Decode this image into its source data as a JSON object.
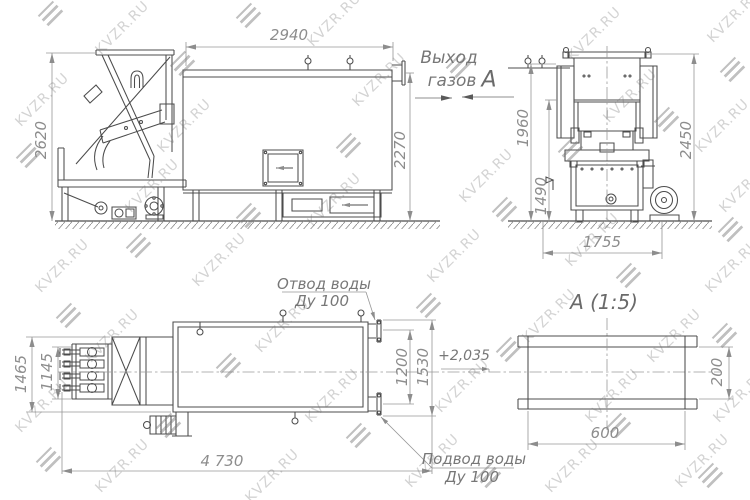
{
  "page": {
    "background": "#ffffff",
    "line_color": "#4c4c4c",
    "dim_color": "#8d8d8d"
  },
  "watermark": {
    "text": "KVZR.RU"
  },
  "drawing": {
    "type": "technical-drawing-boiler",
    "labels": {
      "gas_outlet_line1": "Выход",
      "gas_outlet_line2": "газов",
      "view_arrow_letter": "А",
      "section_title": "А  (1:5)",
      "water_outlet_line1": "Отвод воды",
      "water_outlet_line2": "Ду 100",
      "water_inlet_line1": "Подвод воды",
      "water_inlet_line2": "Ду 100"
    },
    "dimensions": {
      "side_width": "2940",
      "side_height": "2620",
      "side_outlet_height": "2270",
      "front_height_inner": "1960",
      "front_height_total": "2450",
      "front_height_grate": "1490",
      "front_width": "1755",
      "plan_width_total": "1465",
      "plan_width_grate": "1145",
      "plan_length": "4 730",
      "plan_nozzle_span": "1200",
      "plan_nozzle_outer": "1530",
      "elevation_mark": "+2,035",
      "section_width": "600",
      "section_height": "200"
    }
  }
}
